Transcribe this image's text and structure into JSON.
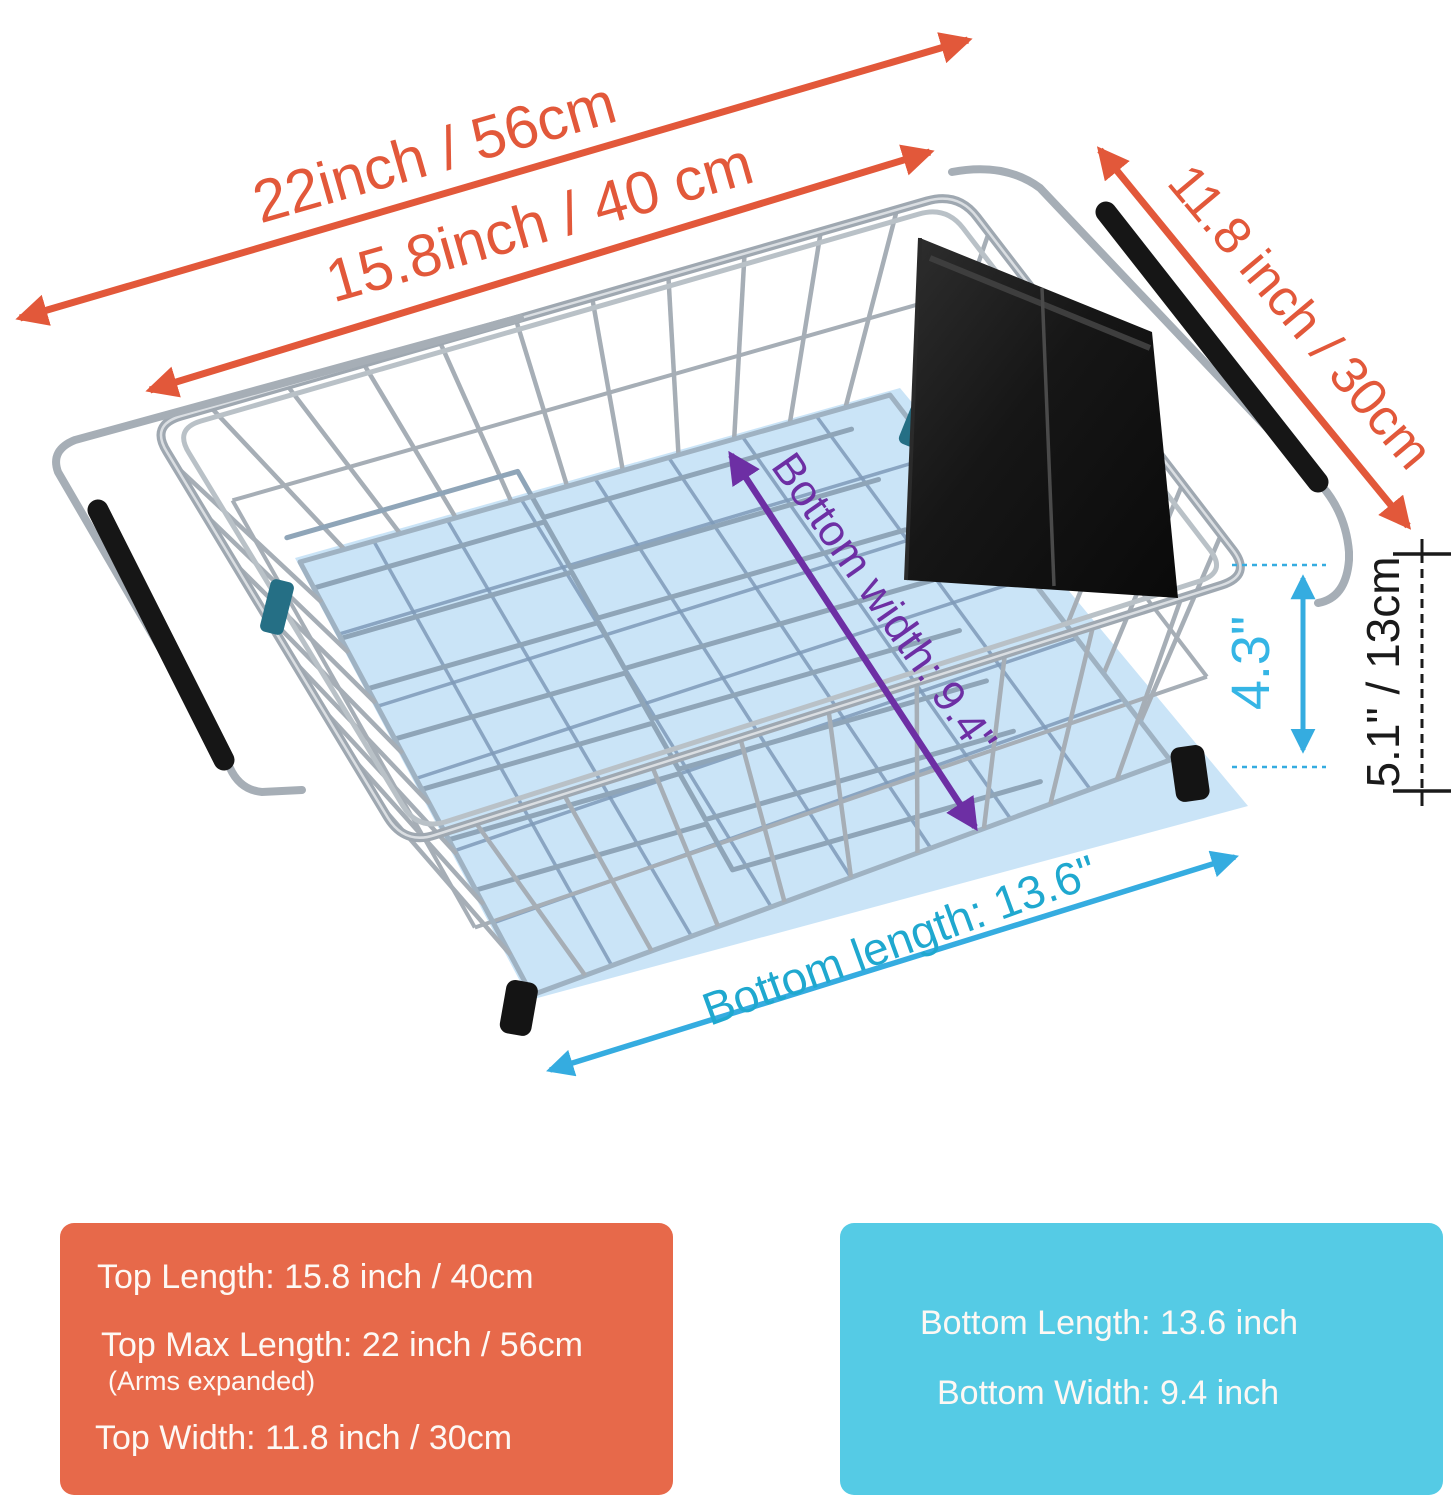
{
  "dimensions": {
    "top_max_length": "22inch / 56cm",
    "top_length": "15.8inch / 40 cm",
    "top_width": "11.8 inch / 30cm",
    "inner_height": "4.3\"",
    "outer_height": "5.1\" / 13cm",
    "bottom_width": "Bottom width: 9.4\"",
    "bottom_length": "Bottom length: 13.6\""
  },
  "info_boxes": {
    "top": {
      "line1": "Top Length: 15.8 inch / 40cm",
      "line2": "Top Max Length:  22 inch / 56cm",
      "line2_note": "(Arms expanded)",
      "line3": "Top Width: 11.8 inch / 30cm"
    },
    "bottom": {
      "line1": "Bottom Length: 13.6 inch",
      "line2": "Bottom Width: 9.4 inch"
    }
  },
  "colors": {
    "orange": "#E2583A",
    "box_orange": "#E7694A",
    "box_cyan": "#55CBE5",
    "cyan_arrow": "#35ACE0",
    "cyan_text": "#1FA8CF",
    "cyan_bright": "#35B5E5",
    "purple": "#6D2FA4",
    "black": "#1A1A1A",
    "white_text": "#FDF8F4",
    "panel_blue": "#C7E3F7",
    "grid_blue": "#7F9BB9",
    "divider_steel": "#8FA5B8",
    "wire_chrome": "#A6AEB6",
    "rim_chrome": "#9FA8B1",
    "rim_highlight": "#DADEE2",
    "floor_edge": "#9FB2C2",
    "grip_black": "#161616",
    "teal_clip": "#256F85",
    "box_black": "#1B1B1B"
  }
}
